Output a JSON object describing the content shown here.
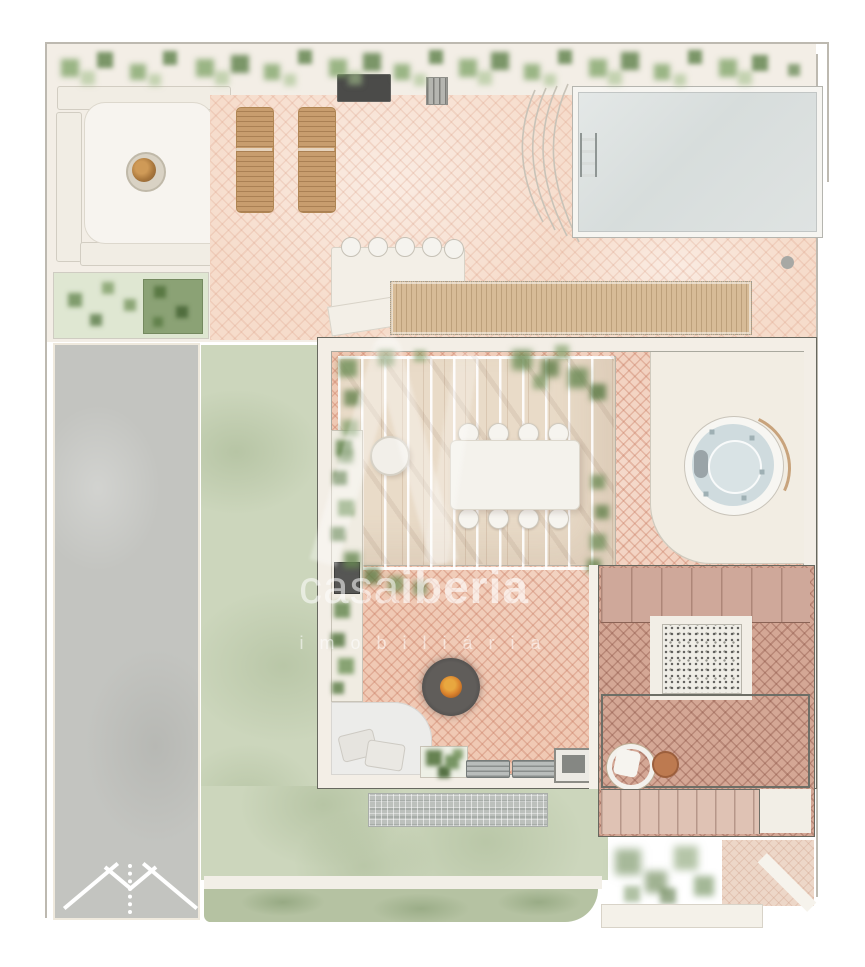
{
  "watermark": {
    "brand_primary": "casa",
    "brand_secondary": "iberia",
    "tagline": "imobiliária"
  },
  "palette": {
    "terracotta_tile": "#f0c9b4",
    "terracotta_pale": "#f6dccb",
    "terracotta_dark": "#d4a795",
    "pool_water": "#dce1e0",
    "jacuzzi_water": "#cfdbde",
    "lawn_green": "#ccd6bc",
    "plant_green": "#7ca264",
    "driveway_grey": "#c3c4c0",
    "deck_wood": "#d7bb97",
    "cream_terrace": "#f3eee6",
    "wall_line": "#67685f",
    "fire_orange": "#d9822d",
    "watermark_white": "#ffffff"
  }
}
